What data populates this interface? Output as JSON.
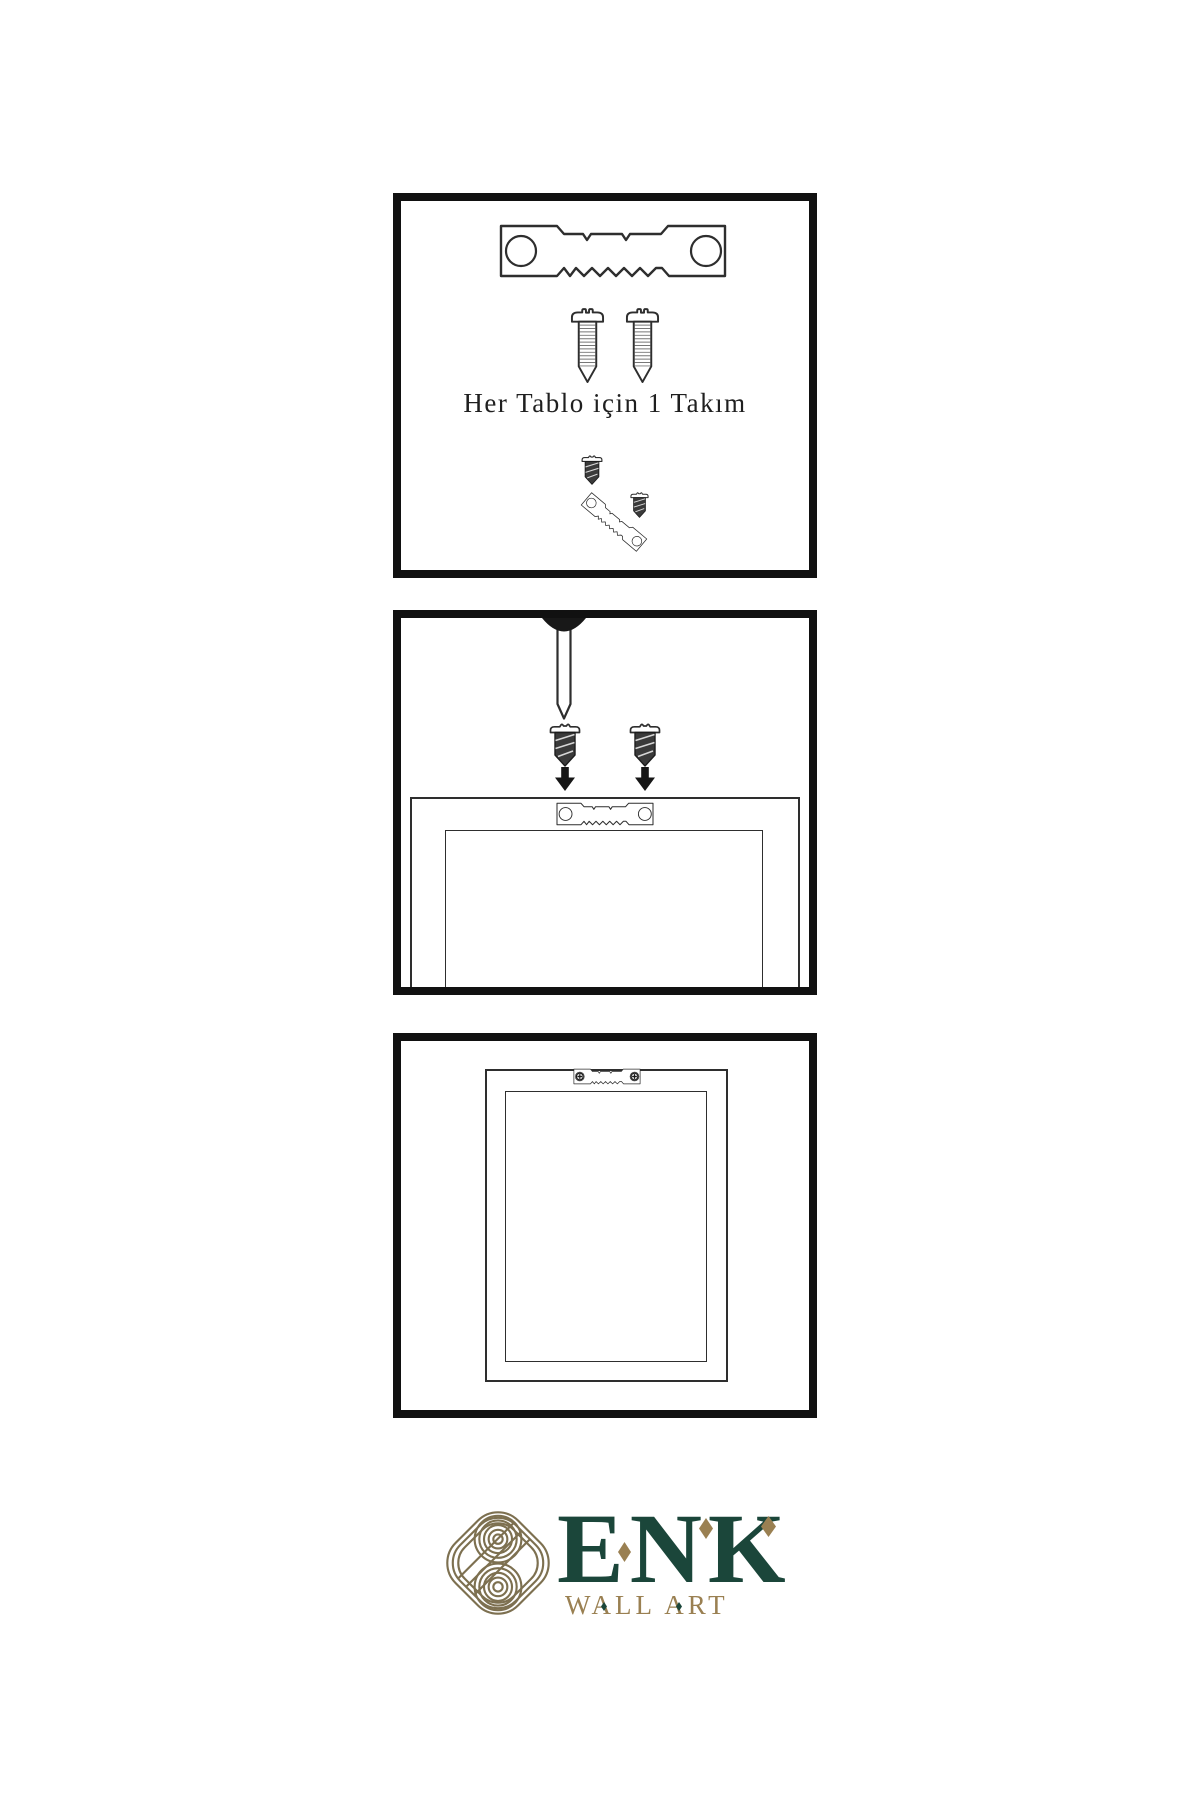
{
  "canvas": {
    "width": 1200,
    "height": 1800,
    "background": "#ffffff"
  },
  "colors": {
    "line": "#2e2e2e",
    "panel_border": "#111111",
    "dark": "#3a3a3a",
    "text": "#1f1f1f",
    "green": "#1b463a",
    "gold": "#9a8052",
    "knot": "#7d7050"
  },
  "panels": [
    {
      "step": 1,
      "caption": "Her Tablo için 1 Takım",
      "icons": [
        "sawtooth-hanger-icon",
        "screw-icon",
        "screw-icon",
        "small-dark-screw-icon",
        "tilted-sawtooth-hanger-icon",
        "small-dark-screw-icon"
      ]
    },
    {
      "step": 2,
      "icons": [
        "wall-nail-icon",
        "dark-screw-icon",
        "dark-screw-icon",
        "arrow-down-icon",
        "arrow-down-icon",
        "sawtooth-hanger-icon",
        "frame-back-icon"
      ]
    },
    {
      "step": 3,
      "icons": [
        "frame-back-icon",
        "mounted-sawtooth-hanger-icon"
      ]
    }
  ],
  "brand": {
    "name": "ENK",
    "subtitle": "WALL ART",
    "icon": "knot-icon"
  }
}
